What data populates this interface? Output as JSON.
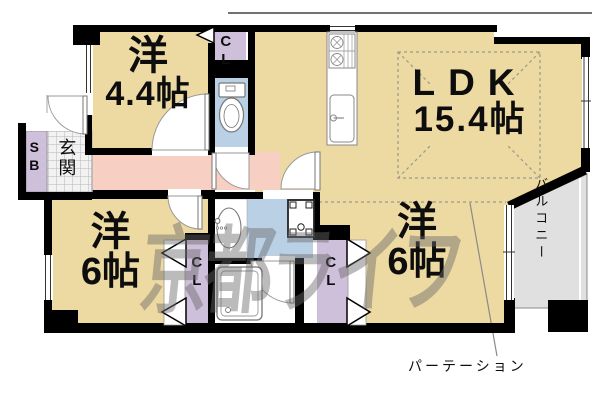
{
  "plan": {
    "watermark": "京都ライフ",
    "rooms": {
      "western_4_4": {
        "type_label": "洋",
        "size_label": "4.4帖"
      },
      "ldk": {
        "type_label": "LDK",
        "size_label": "15.4帖"
      },
      "western_6_left": {
        "type_label": "洋",
        "size_label": "6帖"
      },
      "western_6_right": {
        "type_label": "洋",
        "size_label": "6帖"
      }
    },
    "labels": {
      "entrance": "玄関",
      "shoe_box": "SB",
      "closet_top": "CL",
      "closet_left": "CL",
      "closet_right": "CL",
      "balcony": "バルコニー",
      "partition": "パーテーション"
    },
    "icons": {
      "toilet": "toilet-icon",
      "washbasin": "washbasin-icon",
      "bathtub": "bathtub-icon",
      "washing_machine": "washing-machine-icon",
      "stove": "stove-icon",
      "kitchen_sink": "kitchen-sink-icon"
    },
    "colors": {
      "room_tan": "#EDD9A2",
      "hallway_pink": "#F7D0C3",
      "closet_lavender": "#CEC0DA",
      "wet_area_blue": "#BAD0E4",
      "balcony_gray": "#E0E0E0",
      "wall_black": "#000000",
      "watermark_gray": "#696969"
    }
  }
}
